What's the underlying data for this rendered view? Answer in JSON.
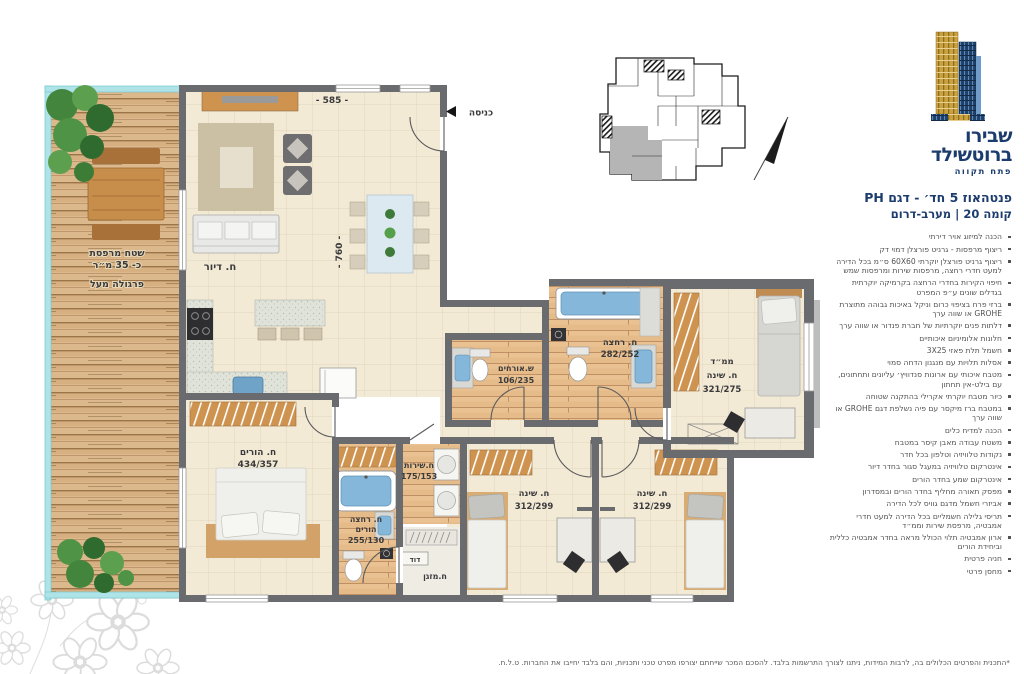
{
  "brand": {
    "name_line1": "שבירו",
    "name_line2": "ברוטשילד",
    "city": "פתח תקווה"
  },
  "header": {
    "title": "פנטהאוז 5 חד׳ - דגם PH",
    "subtitle": "קומה 20 | מערב-דרום"
  },
  "specs": [
    "הכנה למיזוג אויר דירתי",
    "ריצוף מרפסות - גרניט פורצלן דמוי דק",
    "ריצוף גרניט פורצלן יוקרתי 60X60 ס״מ בכל הדירה למעט חדרי רחצה, מרפסות שירות ומרפסות שמש",
    "חיפוי הקירות בחדרי הרחצה בקרמיקה יוקרתית בגדלים שונים ע״פ המפרט",
    "ברזי פרח בציפוי כרום וניקל באיכות גבוהה מתוצרת GROHE או שווה ערך",
    "דלתות פנים יוקרתיות של חברת פנדור או שווה ערך",
    "חלונות אלומיניום איכותיים",
    "חשמל תלת פאזי 3X25",
    "אסלות תלויות עם מנגנון הדחה סמוי",
    "מטבח איכותי עם ארונות סנדוויץ׳ עליונים ותחתונים, עם בילט-אין תחתון",
    "כיור מטבח יוקרתי אקרילי בהתקנה שטוחה",
    "במטבח ברז מיקסר עם פיה נשלפת דגם GROHE או שווה ערך",
    "הכנה למדיח כלים",
    "משטח עבודה מאבן קיסר במטבח",
    "נקודות טלוויזיה וטלפון בכל חדר",
    "אינטרקום טלוויזיה במעגל סגור בחדר דיור",
    "אינטרקום שמע בחדר הורים",
    "מפסק תאורה מחליף בחדר הורים ובמסדרון",
    "אביזרי חשמל מדגם גוויס לכל הדירה",
    "תריסי גלילה חשמליים בכל הדירה למעט חדרי אמבטיה, מרפסת שירות וממ״ד",
    "ארון אמבטיה תלוי הכולל מראה בחדר אמבטיה כללית וביחידת הורים",
    "חניה פרטית",
    "מחסן פרטי"
  ],
  "footnote": "*התכנית והפרטים הכלולים בה, לרבות המידות, ניתנו לצורך התרשמות בלבד. להסכם המכר שייחתם יצורפו מפרט טכני ותכניות, והם בלבד יחייבו את החברות. ט.ל.ח.",
  "plan": {
    "entrance_label": "כניסה",
    "terrace": {
      "line1": "שטח מרפסת",
      "line2": "כ- 35 מ״ר",
      "line3": "פרגולה מעל"
    },
    "dimensions": {
      "living_width": "- 585 -",
      "living_depth": "- 760 -"
    },
    "rooms": {
      "living": {
        "name": "ח. דיור"
      },
      "master": {
        "name": "ח. הורים",
        "dim": "434/357"
      },
      "parents_bath": {
        "name": "ח. רחצה",
        "name2": "הורים",
        "dim": "255/130"
      },
      "service": {
        "name": "ח.שירות",
        "dim": "175/153"
      },
      "boiler": {
        "name": "דוד"
      },
      "ac": {
        "name": "ח.מזגן"
      },
      "guest_wc": {
        "name": "ש.אורחים",
        "dim": "106/235"
      },
      "bathroom": {
        "name": "ח. רחצה",
        "dim": "282/252"
      },
      "mamad": {
        "name": "ממ״ד",
        "name2": "ח. שינה",
        "dim": "321/275"
      },
      "bedroom1": {
        "name": "ח. שינה",
        "dim": "312/299"
      },
      "bedroom2": {
        "name": "ח. שינה",
        "dim": "312/299"
      }
    }
  },
  "colors": {
    "brand_navy": "#1c3c6e",
    "wall_gray": "#6a6b6e",
    "floor_cream": "#f3ead6",
    "deck_wood": "#dcb88d",
    "railing_cyan": "#aee3e8",
    "fixture_blue": "#84b7d9"
  }
}
